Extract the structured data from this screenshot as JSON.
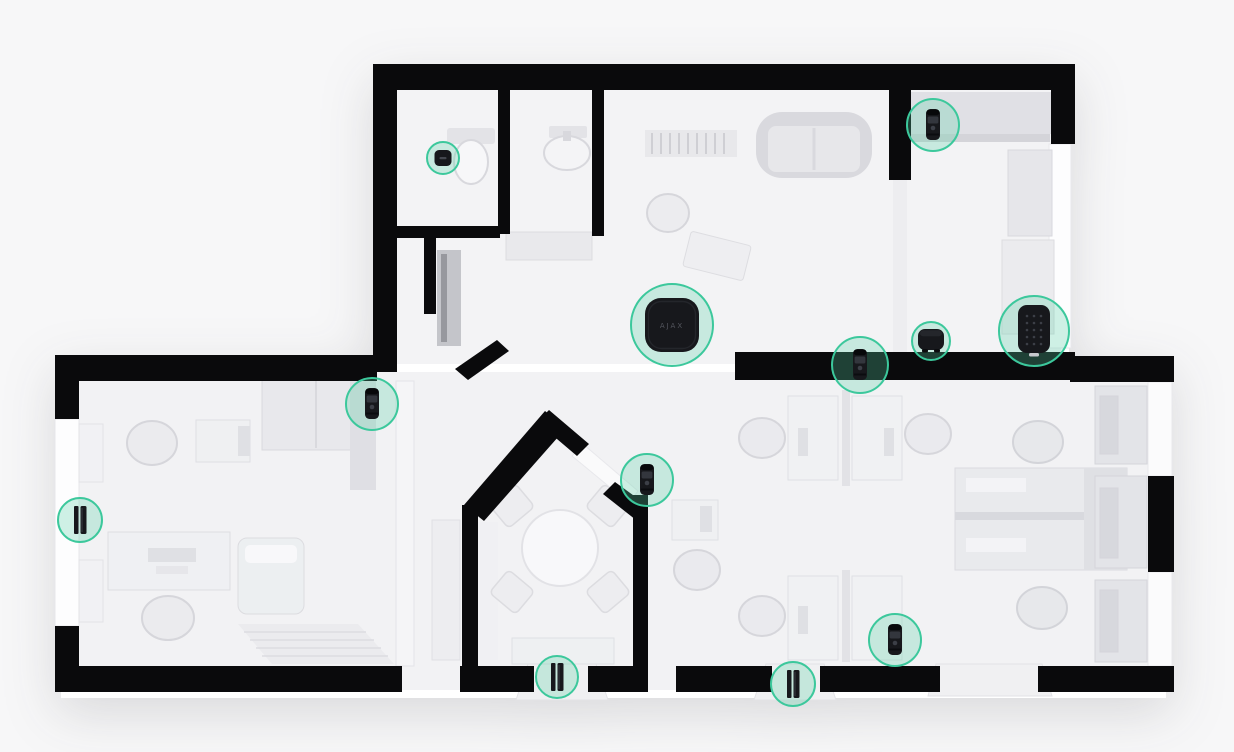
{
  "scene": {
    "description": "3D top-down office floor plan with wireless security devices highlighted by teal circles",
    "background_color": "#f7f7f8",
    "floor_color": "#f3f3f5",
    "wall_color": "#0a0a0c",
    "accent_color": "#3cc89c",
    "accent_fill": "rgba(86,208,164,0.28)",
    "device_body_color": "#17181c"
  },
  "hub": {
    "label": "AJAX"
  },
  "devices": [
    {
      "id": "leak-button-bathroom",
      "type": "button",
      "name": "wall button sensor (bathroom)",
      "x": 443,
      "y": 158,
      "r": 17
    },
    {
      "id": "motion-camera-top-right",
      "type": "motioncam",
      "name": "motion detector (top-right room)",
      "x": 933,
      "y": 125,
      "r": 27
    },
    {
      "id": "hub-central",
      "type": "hub",
      "name": "security hub (central open space)",
      "x": 672,
      "y": 325,
      "r": 42
    },
    {
      "id": "motion-camera-wall-center",
      "type": "motioncam",
      "name": "motion detector (central wall)",
      "x": 860,
      "y": 365,
      "r": 29
    },
    {
      "id": "siren-wall",
      "type": "siren",
      "name": "indoor siren (on wall)",
      "x": 931,
      "y": 341,
      "r": 20
    },
    {
      "id": "keypad-wall",
      "type": "keypad",
      "name": "keypad (on wall)",
      "x": 1034,
      "y": 331,
      "r": 36
    },
    {
      "id": "motion-camera-left-room",
      "type": "motioncam",
      "name": "motion detector (left room corner)",
      "x": 372,
      "y": 404,
      "r": 27
    },
    {
      "id": "motion-camera-meeting-room",
      "type": "motioncam",
      "name": "motion detector (meeting room corner)",
      "x": 647,
      "y": 480,
      "r": 27
    },
    {
      "id": "door-sensor-left-window",
      "type": "doorprotect",
      "name": "opening sensor (left window)",
      "x": 80,
      "y": 520,
      "r": 23
    },
    {
      "id": "door-sensor-meeting-door",
      "type": "doorprotect",
      "name": "opening sensor (meeting room door)",
      "x": 557,
      "y": 677,
      "r": 22
    },
    {
      "id": "door-sensor-office-door",
      "type": "doorprotect",
      "name": "opening sensor (office door)",
      "x": 793,
      "y": 684,
      "r": 23
    },
    {
      "id": "motion-camera-office",
      "type": "motioncam",
      "name": "motion detector (open office)",
      "x": 895,
      "y": 640,
      "r": 27
    }
  ]
}
